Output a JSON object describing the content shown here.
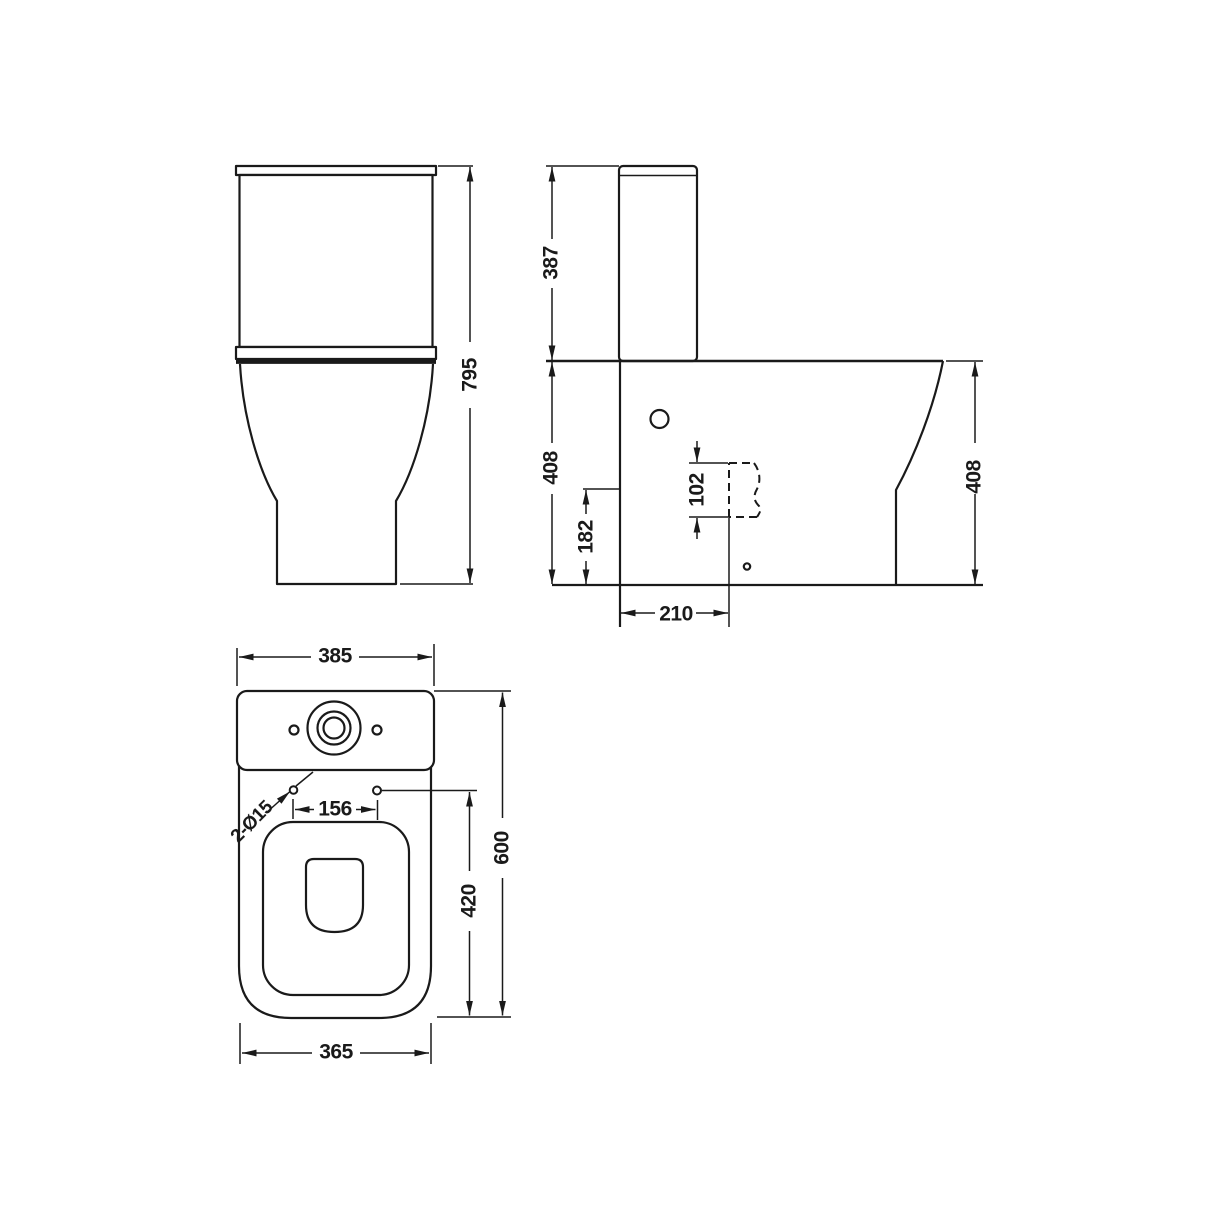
{
  "palette": {
    "line_color": "#1a1a1a",
    "background": "#ffffff"
  },
  "dims": {
    "front": {
      "overall_height": "795"
    },
    "side": {
      "cistern_height": "387",
      "pan_height_front": "408",
      "trap_centre_height": "182",
      "outlet_span": "102",
      "outlet_setout": "210",
      "pan_height_back": "408"
    },
    "plan": {
      "cistern_width": "385",
      "fixing_hole_note": "2-Ø15",
      "fixing_hole_centres": "156",
      "overall_depth": "600",
      "fixing_to_rear": "420",
      "pan_width": "365"
    }
  }
}
